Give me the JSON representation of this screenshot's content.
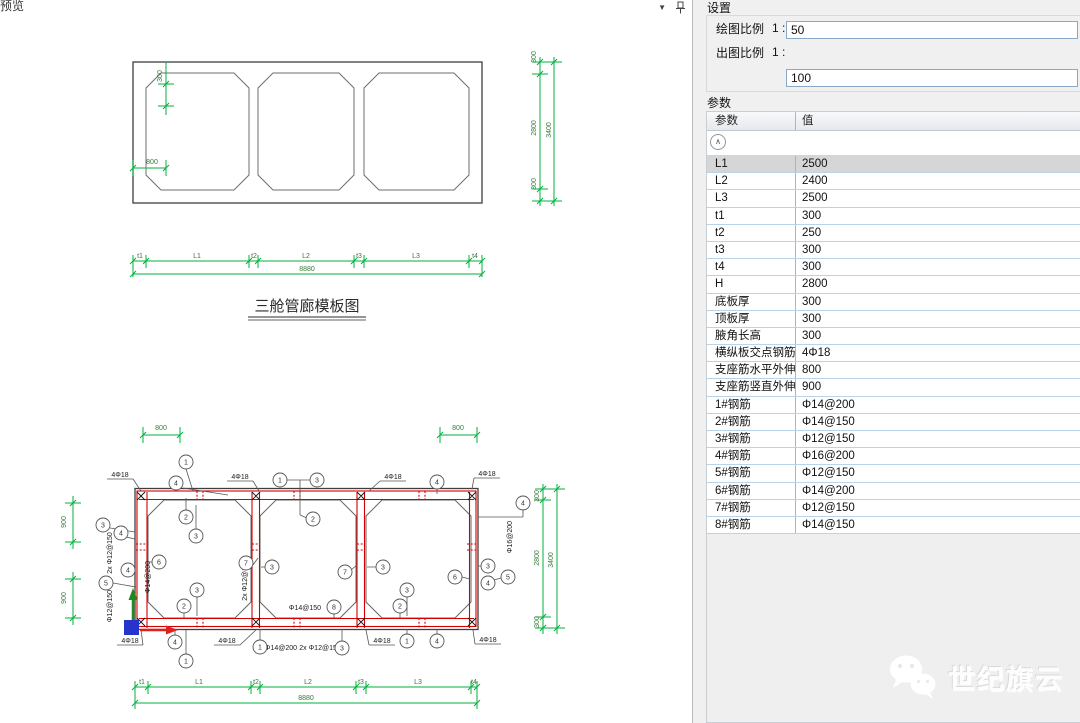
{
  "preview_panel": {
    "tab_label": "预览",
    "collapse_icon": "▼"
  },
  "settings": {
    "title": "设置",
    "draw_scale": {
      "label": "绘图比例",
      "prefix": "1 :",
      "value": "50"
    },
    "plot_scale": {
      "label": "出图比例",
      "prefix": "1 :",
      "value": "100"
    }
  },
  "parameters": {
    "title": "参数",
    "name_col": "参数",
    "value_col": "值",
    "collapse_glyph": "∧",
    "rows": [
      {
        "name": "L1",
        "value": "2500"
      },
      {
        "name": "L2",
        "value": "2400"
      },
      {
        "name": "L3",
        "value": "2500"
      },
      {
        "name": "t1",
        "value": "300"
      },
      {
        "name": "t2",
        "value": "250"
      },
      {
        "name": "t3",
        "value": "300"
      },
      {
        "name": "t4",
        "value": "300"
      },
      {
        "name": "H",
        "value": "2800"
      },
      {
        "name": "底板厚",
        "value": "300"
      },
      {
        "name": "顶板厚",
        "value": "300"
      },
      {
        "name": "腋角长高",
        "value": "300"
      },
      {
        "name": "横纵板交点钢筋",
        "value": "4Φ18"
      },
      {
        "name": "支座筋水平外伸",
        "value": "800"
      },
      {
        "name": "支座筋竖直外伸",
        "value": "900"
      },
      {
        "name": "1#钢筋",
        "value": "Φ14@200"
      },
      {
        "name": "2#钢筋",
        "value": "Φ14@150"
      },
      {
        "name": "3#钢筋",
        "value": "Φ12@150"
      },
      {
        "name": "4#钢筋",
        "value": "Φ16@200"
      },
      {
        "name": "5#钢筋",
        "value": "Φ12@150"
      },
      {
        "name": "6#钢筋",
        "value": "Φ14@200"
      },
      {
        "name": "7#钢筋",
        "value": "Φ12@150"
      },
      {
        "name": "8#钢筋",
        "value": "Φ14@150"
      }
    ]
  },
  "watermark": {
    "brand": "世纪旗云"
  },
  "drawing": {
    "title": "三舱管廊模板图",
    "colors": {
      "dim_line": "#00b23d",
      "dim_text": "#357a35",
      "rebar": "#d40000",
      "outline": "#3f3f3f"
    },
    "top_labels": [
      {
        "t": "300",
        "x": 162,
        "y": 76,
        "r": -90,
        "k": "d"
      },
      {
        "t": "800",
        "x": 152,
        "y": 164,
        "k": "d"
      },
      {
        "t": "300",
        "x": 536,
        "y": 57,
        "r": -90,
        "k": "d"
      },
      {
        "t": "2800",
        "x": 536,
        "y": 128,
        "r": -90,
        "k": "d"
      },
      {
        "t": "300",
        "x": 536,
        "y": 184,
        "r": -90,
        "k": "d"
      },
      {
        "t": "3400",
        "x": 551,
        "y": 130,
        "r": -90,
        "k": "d"
      },
      {
        "t": "t1",
        "x": 140,
        "y": 258,
        "k": "d"
      },
      {
        "t": "L1",
        "x": 197,
        "y": 258,
        "k": "d"
      },
      {
        "t": "t2",
        "x": 254,
        "y": 258,
        "k": "d"
      },
      {
        "t": "L2",
        "x": 306,
        "y": 258,
        "k": "d"
      },
      {
        "t": "t3",
        "x": 359,
        "y": 258,
        "k": "d"
      },
      {
        "t": "L3",
        "x": 416,
        "y": 258,
        "k": "d"
      },
      {
        "t": "t4",
        "x": 475,
        "y": 258,
        "k": "d"
      },
      {
        "t": "8880",
        "x": 307,
        "y": 271,
        "k": "d"
      }
    ],
    "bottom_labels": [
      {
        "t": "800",
        "x": 161,
        "y": 430,
        "k": "d"
      },
      {
        "t": "800",
        "x": 458,
        "y": 430,
        "k": "d"
      },
      {
        "t": "900",
        "x": 66,
        "y": 522,
        "r": -90,
        "k": "d"
      },
      {
        "t": "900",
        "x": 66,
        "y": 598,
        "r": -90,
        "k": "d"
      },
      {
        "t": "4Φ18",
        "x": 120,
        "y": 477,
        "k": "r"
      },
      {
        "t": "4Φ18",
        "x": 240,
        "y": 479,
        "k": "r"
      },
      {
        "t": "4Φ18",
        "x": 393,
        "y": 479,
        "k": "r"
      },
      {
        "t": "4Φ18",
        "x": 487,
        "y": 476,
        "k": "r"
      },
      {
        "t": "Φ16@200",
        "x": 512,
        "y": 537,
        "r": -90,
        "k": "r"
      },
      {
        "t": "2x Φ12@150",
        "x": 112,
        "y": 553,
        "r": -90,
        "k": "r"
      },
      {
        "t": "Φ12@150",
        "x": 112,
        "y": 606,
        "r": -90,
        "k": "r"
      },
      {
        "t": "Φ14@200",
        "x": 150,
        "y": 577,
        "r": -90,
        "k": "r"
      },
      {
        "t": "2x Φ12@150",
        "x": 247,
        "y": 580,
        "r": -90,
        "k": "r"
      },
      {
        "t": "Φ14@150",
        "x": 305,
        "y": 610,
        "k": "r"
      },
      {
        "t": "Φ14@200",
        "x": 281,
        "y": 650,
        "k": "r"
      },
      {
        "t": "2x Φ12@150",
        "x": 320,
        "y": 650,
        "k": "r"
      },
      {
        "t": "4Φ18",
        "x": 130,
        "y": 643,
        "k": "r"
      },
      {
        "t": "4Φ18",
        "x": 227,
        "y": 643,
        "k": "r"
      },
      {
        "t": "4Φ18",
        "x": 382,
        "y": 643,
        "k": "r"
      },
      {
        "t": "4Φ18",
        "x": 488,
        "y": 642,
        "k": "r"
      },
      {
        "t": "300",
        "x": 539,
        "y": 496,
        "r": -90,
        "k": "d"
      },
      {
        "t": "2800",
        "x": 539,
        "y": 558,
        "r": -90,
        "k": "d"
      },
      {
        "t": "300",
        "x": 539,
        "y": 622,
        "r": -90,
        "k": "d"
      },
      {
        "t": "3400",
        "x": 553,
        "y": 560,
        "r": -90,
        "k": "d"
      },
      {
        "t": "t1",
        "x": 142,
        "y": 684,
        "k": "d"
      },
      {
        "t": "L1",
        "x": 199,
        "y": 684,
        "k": "d"
      },
      {
        "t": "t2",
        "x": 256,
        "y": 684,
        "k": "d"
      },
      {
        "t": "L2",
        "x": 308,
        "y": 684,
        "k": "d"
      },
      {
        "t": "t3",
        "x": 361,
        "y": 684,
        "k": "d"
      },
      {
        "t": "L3",
        "x": 418,
        "y": 684,
        "k": "d"
      },
      {
        "t": "t4",
        "x": 474,
        "y": 684,
        "k": "d"
      },
      {
        "t": "8880",
        "x": 306,
        "y": 700,
        "k": "d"
      }
    ],
    "bubbles": [
      {
        "n": "1",
        "x": 186,
        "y": 462
      },
      {
        "n": "4",
        "x": 176,
        "y": 483
      },
      {
        "n": "2",
        "x": 186,
        "y": 517
      },
      {
        "n": "3",
        "x": 196,
        "y": 536
      },
      {
        "n": "1",
        "x": 280,
        "y": 480
      },
      {
        "n": "3",
        "x": 317,
        "y": 480
      },
      {
        "n": "2",
        "x": 313,
        "y": 519
      },
      {
        "n": "4",
        "x": 437,
        "y": 482
      },
      {
        "n": "4",
        "x": 523,
        "y": 503
      },
      {
        "n": "3",
        "x": 103,
        "y": 525
      },
      {
        "n": "4",
        "x": 121,
        "y": 533
      },
      {
        "n": "4",
        "x": 128,
        "y": 570
      },
      {
        "n": "5",
        "x": 106,
        "y": 583
      },
      {
        "n": "6",
        "x": 159,
        "y": 562
      },
      {
        "n": "7",
        "x": 246,
        "y": 563
      },
      {
        "n": "3",
        "x": 272,
        "y": 567
      },
      {
        "n": "7",
        "x": 345,
        "y": 572
      },
      {
        "n": "3",
        "x": 383,
        "y": 567
      },
      {
        "n": "3",
        "x": 488,
        "y": 566
      },
      {
        "n": "6",
        "x": 455,
        "y": 577
      },
      {
        "n": "4",
        "x": 488,
        "y": 583
      },
      {
        "n": "5",
        "x": 508,
        "y": 577
      },
      {
        "n": "3",
        "x": 197,
        "y": 590
      },
      {
        "n": "2",
        "x": 184,
        "y": 606
      },
      {
        "n": "8",
        "x": 334,
        "y": 607
      },
      {
        "n": "3",
        "x": 407,
        "y": 590
      },
      {
        "n": "2",
        "x": 400,
        "y": 606
      },
      {
        "n": "4",
        "x": 175,
        "y": 642
      },
      {
        "n": "1",
        "x": 186,
        "y": 661
      },
      {
        "n": "1",
        "x": 260,
        "y": 647
      },
      {
        "n": "3",
        "x": 342,
        "y": 648
      },
      {
        "n": "1",
        "x": 407,
        "y": 641
      },
      {
        "n": "4",
        "x": 437,
        "y": 641
      }
    ]
  }
}
